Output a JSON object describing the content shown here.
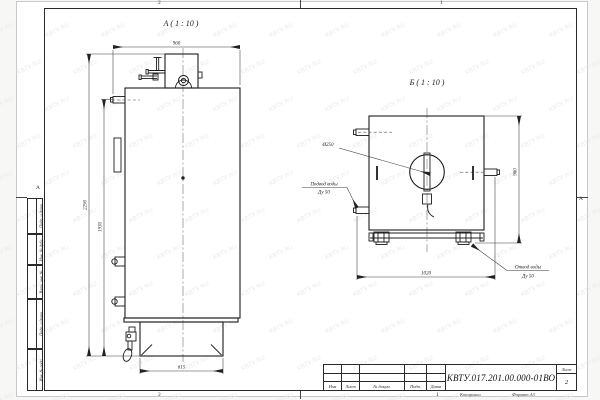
{
  "watermark": {
    "text": "КВТУ.RU"
  },
  "frame": {
    "zone_top_left": "2",
    "zone_top_right": "1",
    "zone_bottom_left": "2",
    "zone_bottom_right": "1",
    "zone_row_left": "А",
    "zone_row_right": "А"
  },
  "sidebar": {
    "cells": [
      "Подп. и дата",
      "Инв. № дубл.",
      "Взам. инв. №",
      "Подп. и дата",
      "Инв. № подл."
    ]
  },
  "views": {
    "front": {
      "label": "А ( 1 : 10 )",
      "dims": {
        "width_top": "960",
        "height_total": "2290",
        "height_body": "1930",
        "base_width": "615"
      }
    },
    "side": {
      "label": "Б ( 1 : 10 )",
      "dims": {
        "diameter": "Ø250",
        "width_bottom": "1020",
        "height_right": "960"
      },
      "callouts": {
        "inlet_line1": "Подвод воды",
        "inlet_line2": "Ду 50",
        "outlet_line1": "Отвод воды",
        "outlet_line2": "Ду 50"
      }
    }
  },
  "title_block": {
    "doc_number": "КВТУ.017.201.00.000-01ВО",
    "columns": [
      "Изм",
      "Лист",
      "№ докум.",
      "Подп.",
      "Дата"
    ],
    "sheet_label": "Лист",
    "sheet_value": "2",
    "footer": {
      "zone": "1",
      "copied": "Копировал",
      "format": "Формат А3"
    }
  }
}
